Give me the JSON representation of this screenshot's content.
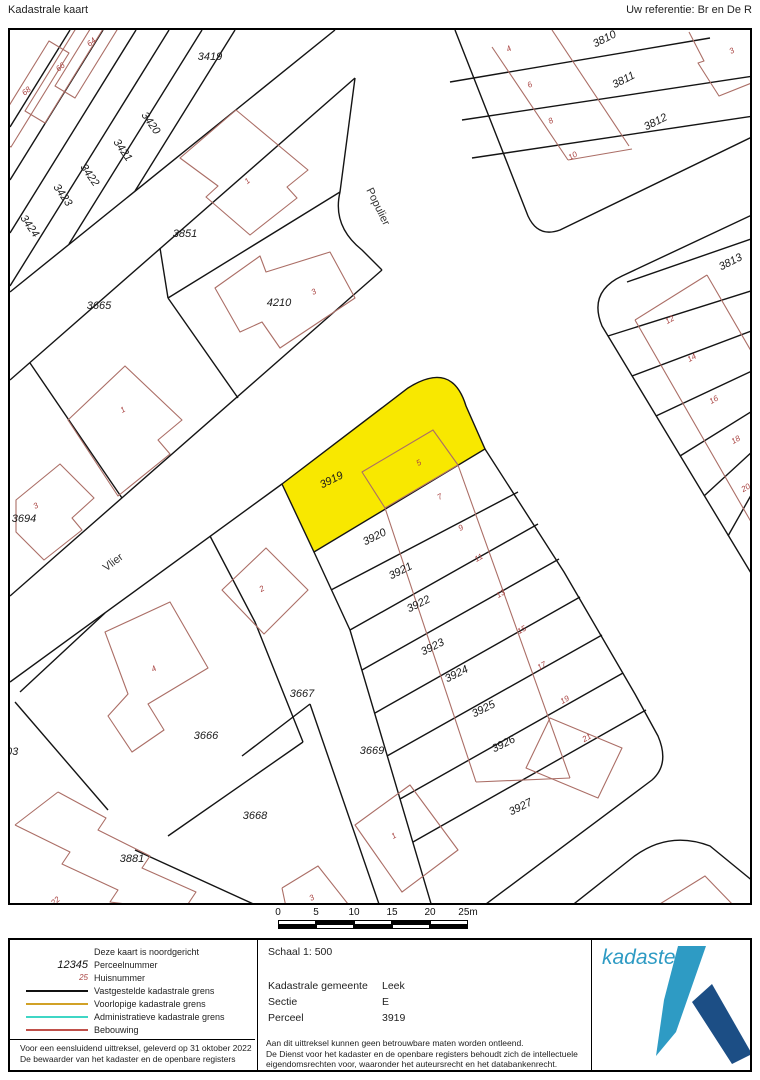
{
  "header": {
    "title": "Kadastrale kaart",
    "reference": "Uw referentie: Br en De R"
  },
  "map": {
    "highlight_parcel": "3919",
    "colors": {
      "highlight": "#f8e800",
      "boundary": "#141414",
      "building": "#ab6e66",
      "house_number": "#a94442"
    },
    "street_names": [
      {
        "label": "Populier",
        "x": 365,
        "y": 178,
        "r": 64
      },
      {
        "label": "Vlier",
        "x": 105,
        "y": 535,
        "r": -37
      }
    ],
    "parcel_labels": [
      {
        "label": "3419",
        "x": 200,
        "y": 30,
        "r": 0
      },
      {
        "label": "3420",
        "x": 138,
        "y": 95,
        "r": 55
      },
      {
        "label": "3421",
        "x": 110,
        "y": 122,
        "r": 55
      },
      {
        "label": "3422",
        "x": 77,
        "y": 147,
        "r": 55
      },
      {
        "label": "3423",
        "x": 50,
        "y": 167,
        "r": 55
      },
      {
        "label": "3424",
        "x": 17,
        "y": 198,
        "r": 55
      },
      {
        "label": "3851",
        "x": 175,
        "y": 207,
        "r": 0
      },
      {
        "label": "3665",
        "x": 89,
        "y": 279,
        "r": 0
      },
      {
        "label": "4210",
        "x": 269,
        "y": 276,
        "r": 0
      },
      {
        "label": "3694",
        "x": 14,
        "y": 492,
        "r": 0
      },
      {
        "label": "3666",
        "x": 196,
        "y": 709,
        "r": 0
      },
      {
        "label": "3667",
        "x": 292,
        "y": 667,
        "r": 0
      },
      {
        "label": "3668",
        "x": 245,
        "y": 789,
        "r": 0
      },
      {
        "label": "3669",
        "x": 362,
        "y": 724,
        "r": 0
      },
      {
        "label": "3881",
        "x": 122,
        "y": 832,
        "r": 0
      },
      {
        "label": "3903",
        "x": -4,
        "y": 725,
        "r": 0
      },
      {
        "label": "3810",
        "x": 596,
        "y": 12,
        "r": -27
      },
      {
        "label": "3811",
        "x": 615,
        "y": 53,
        "r": -27
      },
      {
        "label": "3812",
        "x": 647,
        "y": 95,
        "r": -27
      },
      {
        "label": "3813",
        "x": 722,
        "y": 235,
        "r": -27
      },
      {
        "label": "3919",
        "x": 323,
        "y": 453,
        "r": -27
      },
      {
        "label": "3920",
        "x": 366,
        "y": 510,
        "r": -27
      },
      {
        "label": "3921",
        "x": 392,
        "y": 544,
        "r": -27
      },
      {
        "label": "3922",
        "x": 410,
        "y": 577,
        "r": -27
      },
      {
        "label": "3923",
        "x": 424,
        "y": 620,
        "r": -27
      },
      {
        "label": "3924",
        "x": 448,
        "y": 647,
        "r": -27
      },
      {
        "label": "3925",
        "x": 475,
        "y": 682,
        "r": -27
      },
      {
        "label": "3926",
        "x": 495,
        "y": 717,
        "r": -27
      },
      {
        "label": "3927",
        "x": 512,
        "y": 780,
        "r": -27
      }
    ],
    "house_numbers": [
      {
        "label": "64",
        "x": 83,
        "y": 14,
        "r": -40
      },
      {
        "label": "66",
        "x": 52,
        "y": 39,
        "r": -40
      },
      {
        "label": "68",
        "x": 18,
        "y": 63,
        "r": -40
      },
      {
        "label": "1",
        "x": 239,
        "y": 153,
        "r": -40
      },
      {
        "label": "3",
        "x": 305,
        "y": 264,
        "r": -30
      },
      {
        "label": "1",
        "x": 114,
        "y": 382,
        "r": -30
      },
      {
        "label": "3",
        "x": 27,
        "y": 478,
        "r": -30
      },
      {
        "label": "2",
        "x": 253,
        "y": 561,
        "r": -30
      },
      {
        "label": "4",
        "x": 145,
        "y": 641,
        "r": -30
      },
      {
        "label": "1",
        "x": 385,
        "y": 808,
        "r": -30
      },
      {
        "label": "3",
        "x": 303,
        "y": 870,
        "r": -30
      },
      {
        "label": "22",
        "x": 47,
        "y": 873,
        "r": -40
      },
      {
        "label": "5",
        "x": 410,
        "y": 435,
        "r": -30
      },
      {
        "label": "7",
        "x": 431,
        "y": 469,
        "r": -30
      },
      {
        "label": "9",
        "x": 452,
        "y": 500,
        "r": -30
      },
      {
        "label": "11",
        "x": 470,
        "y": 530,
        "r": -30
      },
      {
        "label": "13",
        "x": 492,
        "y": 566,
        "r": -30
      },
      {
        "label": "15",
        "x": 513,
        "y": 602,
        "r": -30
      },
      {
        "label": "17",
        "x": 533,
        "y": 638,
        "r": -30
      },
      {
        "label": "19",
        "x": 556,
        "y": 672,
        "r": -30
      },
      {
        "label": "21",
        "x": 578,
        "y": 710,
        "r": -30
      },
      {
        "label": "4",
        "x": 500,
        "y": 21,
        "r": -30
      },
      {
        "label": "6",
        "x": 521,
        "y": 57,
        "r": -30
      },
      {
        "label": "8",
        "x": 542,
        "y": 93,
        "r": -30
      },
      {
        "label": "10",
        "x": 564,
        "y": 128,
        "r": -30
      },
      {
        "label": "3",
        "x": 723,
        "y": 23,
        "r": -30
      },
      {
        "label": "12",
        "x": 661,
        "y": 292,
        "r": -30
      },
      {
        "label": "14",
        "x": 683,
        "y": 330,
        "r": -30
      },
      {
        "label": "16",
        "x": 705,
        "y": 372,
        "r": -30
      },
      {
        "label": "18",
        "x": 727,
        "y": 412,
        "r": -30
      },
      {
        "label": "20",
        "x": 737,
        "y": 460,
        "r": -30
      }
    ]
  },
  "scalebar": {
    "labels": [
      "0",
      "5",
      "10",
      "15",
      "20",
      "25m"
    ]
  },
  "legend": {
    "items": [
      {
        "symbol": "none",
        "sample": "",
        "label": "Deze kaart is noordgericht"
      },
      {
        "symbol": "parcel",
        "sample": "12345",
        "label": "Perceelnummer"
      },
      {
        "symbol": "house",
        "sample": "25",
        "label": "Huisnummer"
      },
      {
        "symbol": "line",
        "color": "#111111",
        "label": "Vastgestelde kadastrale grens"
      },
      {
        "symbol": "line",
        "color": "#d1a126",
        "label": "Voorlopige kadastrale grens"
      },
      {
        "symbol": "line",
        "color": "#3fd6c5",
        "label": "Administratieve kadastrale grens"
      },
      {
        "symbol": "line",
        "color": "#c0504a",
        "label": "Bebouwing"
      }
    ],
    "notes": [
      "Voor een eensluidend uittreksel, geleverd op 31 oktober 2022",
      "De bewaarder van het kadaster en de openbare registers"
    ]
  },
  "details": {
    "schaal": "Schaal 1: 500",
    "rows": [
      {
        "label": "Kadastrale gemeente",
        "value": "Leek"
      },
      {
        "label": "Sectie",
        "value": "E"
      },
      {
        "label": "Perceel",
        "value": "3919"
      }
    ],
    "disclaimer": [
      "Aan dit uittreksel kunnen geen betrouwbare maten worden ontleend.",
      "De Dienst voor het kadaster en de openbare registers behoudt zich de intellectuele",
      "eigendomsrechten voor, waaronder het auteursrecht en het databankenrecht."
    ]
  },
  "logo": {
    "text": "kadaster",
    "light_color": "#2e9bc4",
    "dark_color": "#1c4e85"
  }
}
